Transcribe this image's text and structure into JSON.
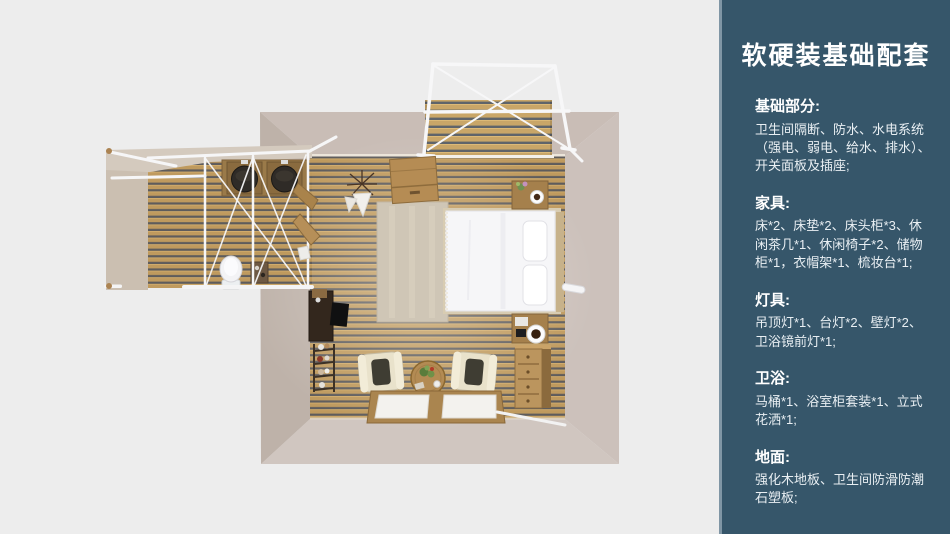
{
  "sidebar": {
    "title": "软硬装基础配套",
    "sections": [
      {
        "heading": "基础部分:",
        "body": "卫生间隔断、防水、水电系统\n（强电、弱电、给水、排水）、\n开关面板及插座;"
      },
      {
        "heading": "家具:",
        "body": "床*2、床垫*2、床头柜*3、休\n闲茶几*1、休闲椅子*2、储物\n柜*1，衣帽架*1、梳妆台*1;"
      },
      {
        "heading": "灯具:",
        "body": "吊顶灯*1、台灯*2、壁灯*2、\n卫浴镜前灯*1;"
      },
      {
        "heading": "卫浴:",
        "body": "马桶*1、浴室柜套装*1、立式\n花洒*1;"
      },
      {
        "heading": "地面:",
        "body": "强化木地板、卫生间防滑防潮\n石塑板;"
      }
    ]
  },
  "floorplan": {
    "view": "top-down-3d-render",
    "rooms": [
      "bedroom",
      "bathroom-wing",
      "outdoor-deck"
    ],
    "furniture_icons": [
      "canopy-pergola-frame",
      "outdoor-deck",
      "storage-cabinet",
      "dried-plant",
      "area-rug",
      "double-bed",
      "pillows",
      "nightstand",
      "coffee-cup",
      "writing-desk",
      "ladder-shelf",
      "lounge-chair",
      "round-tea-table",
      "floor-windows",
      "chest-of-drawers",
      "bathroom-vanity-double-sinks",
      "toilet",
      "glass-partition-frame",
      "wall-coat-rack"
    ],
    "colors": {
      "page_background": "#ededed",
      "sidebar_background": "#36566a",
      "sidebar_edge": "#8096a5",
      "text": "#ffffff",
      "wood_floor": "#bf9a5e",
      "plank_gap": "#5e5c5c",
      "deck_wood": "#c9a668",
      "wall_beige": "#c9bdb6",
      "frame_white": "#f6f6f7",
      "bed_white": "#f6f6f8",
      "chair_cream": "#e9e2cb",
      "furniture_wood": "#a5804c"
    }
  }
}
